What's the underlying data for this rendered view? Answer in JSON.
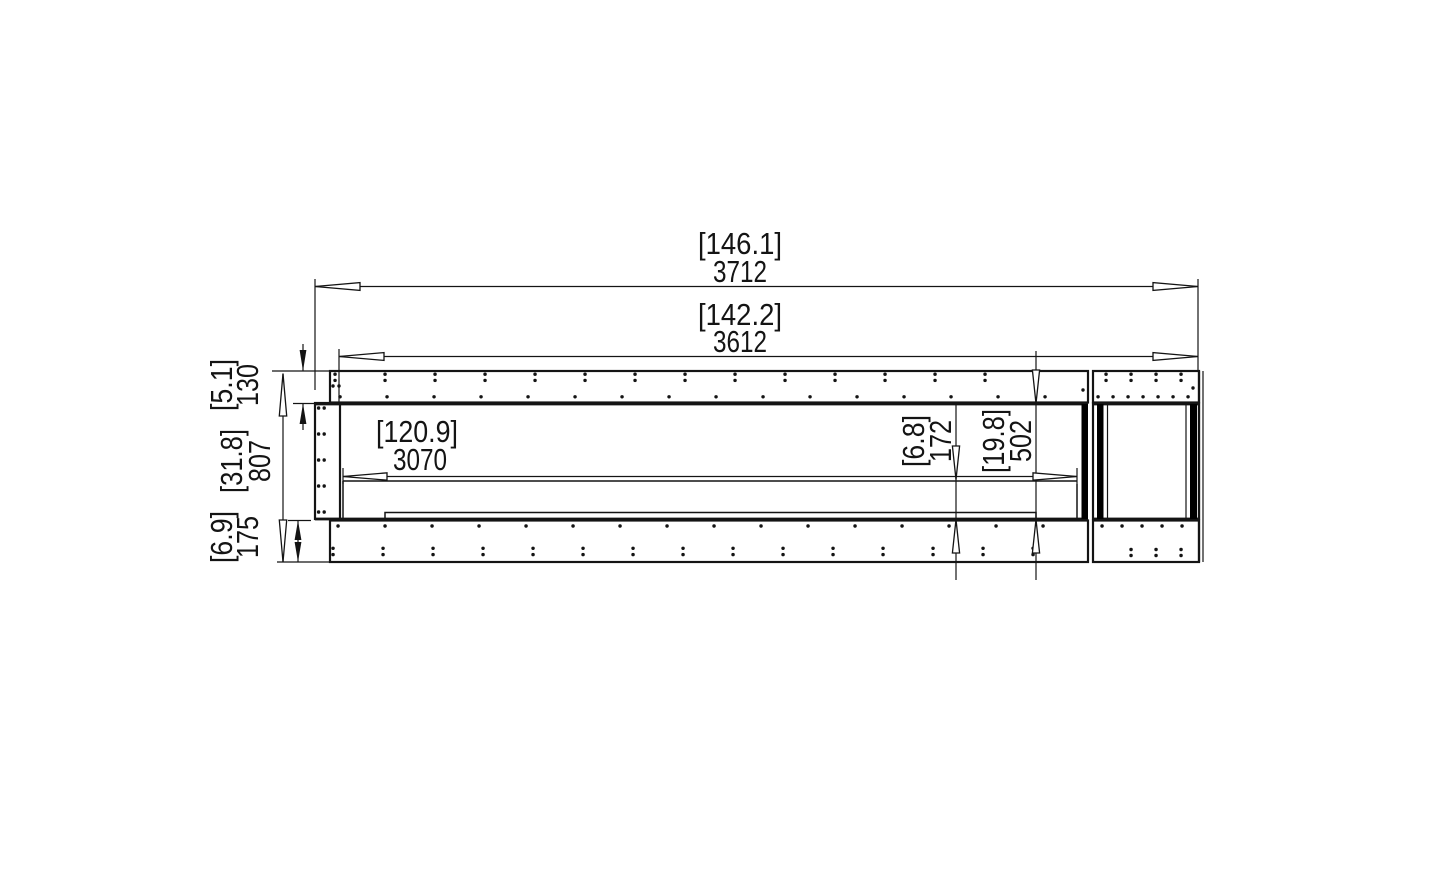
{
  "drawing": {
    "title": "firebox-front-elevation-technical-drawing",
    "units_note": "[inches] over millimetres",
    "colors": {
      "line": "#141414",
      "glass_bar": "#000000",
      "background": "#ffffff"
    },
    "dims": {
      "overall_width_in": "[146.1]",
      "overall_width_mm": "3712",
      "fascia_width_in": "[142.2]",
      "fascia_width_mm": "3612",
      "opening_width_in": "[120.9]",
      "opening_width_mm": "3070",
      "top_flange_height_in": "[5.1]",
      "top_flange_height_mm": "130",
      "overall_height_in": "[31.8]",
      "overall_height_mm": "807",
      "bottom_flange_height_in": "[6.9]",
      "bottom_flange_height_mm": "175",
      "ledge_height_in": "[6.8]",
      "ledge_height_mm": "172",
      "opening_height_in": "[19.8]",
      "opening_height_mm": "502"
    }
  }
}
